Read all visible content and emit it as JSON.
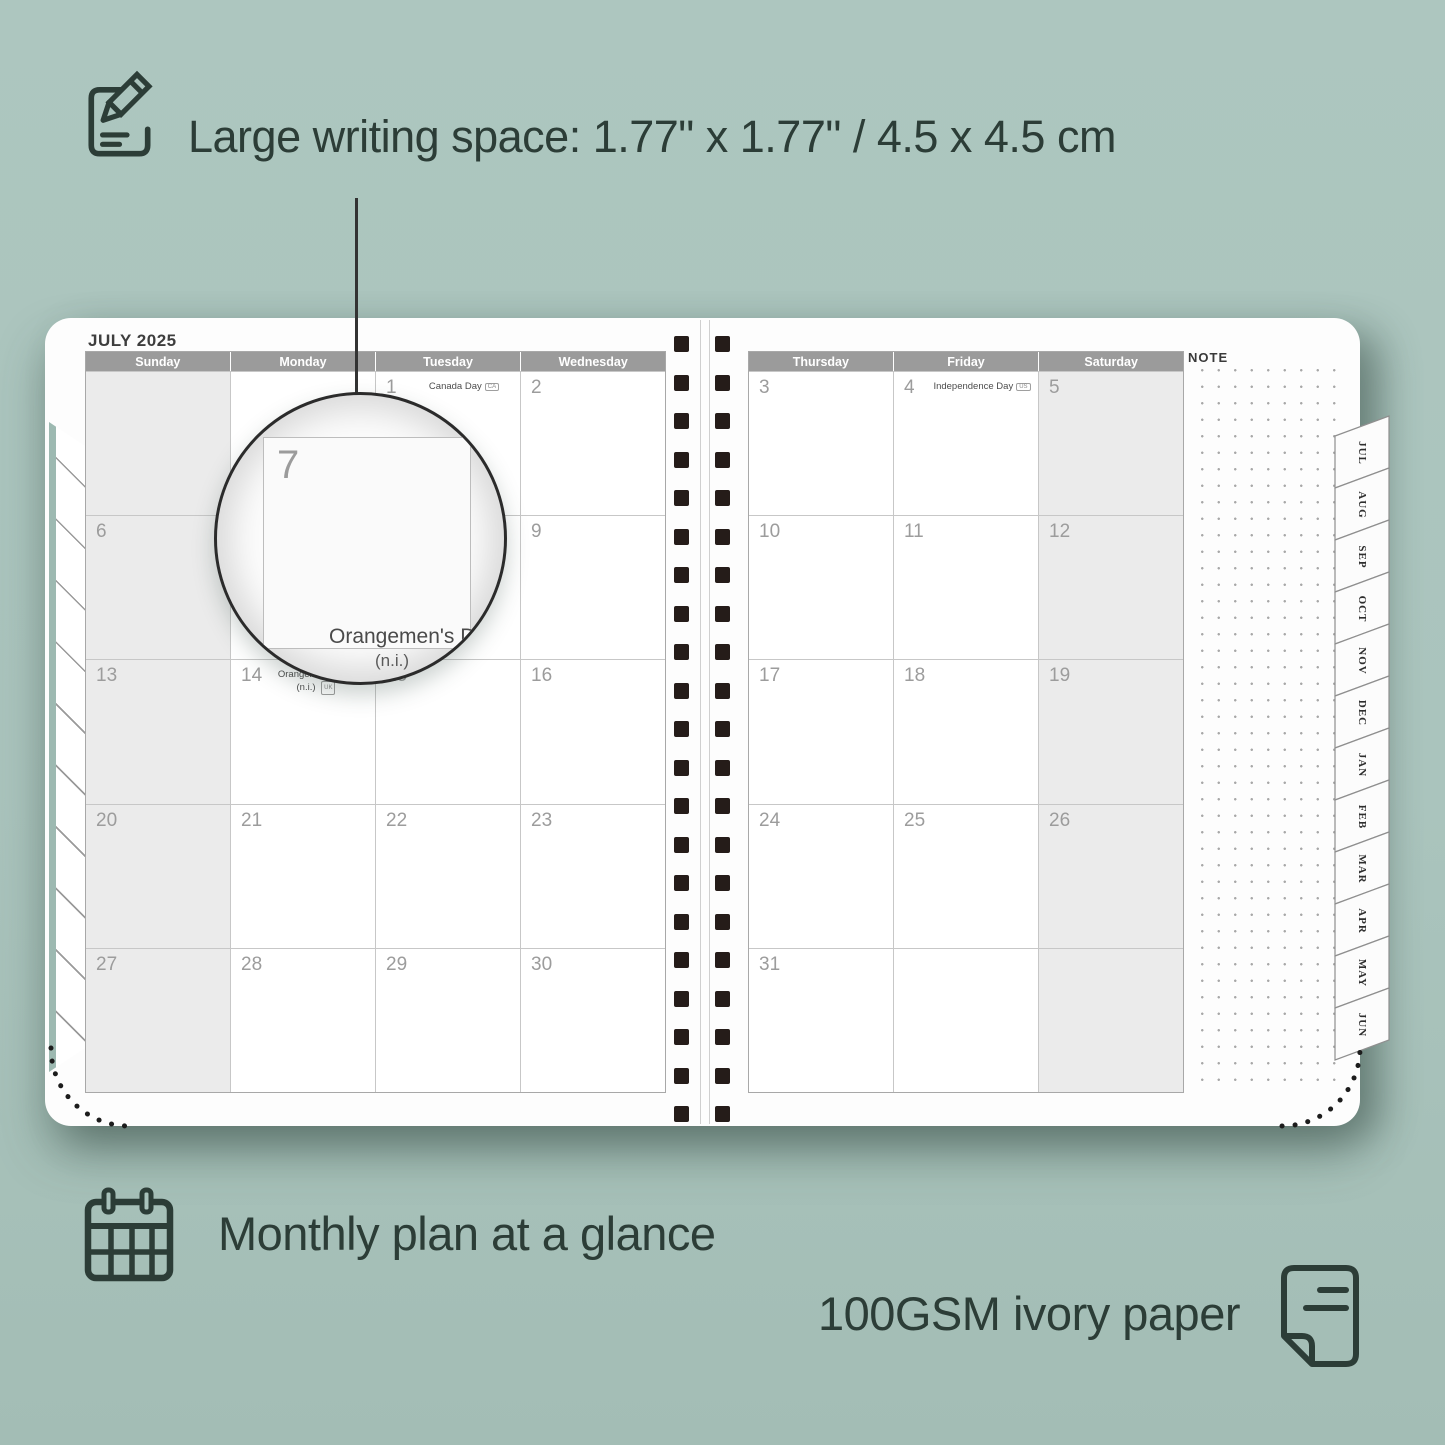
{
  "colors": {
    "background": "#aac4bd",
    "ink": "#2c3d37",
    "header_gray": "#9b9b9b",
    "weekend_shade": "#ebebeb",
    "binding_square": "#251c19",
    "page_white": "#fdfdfd"
  },
  "icons": {
    "top": "note-pencil-icon",
    "bottom_left": "calendar-grid-icon",
    "bottom_right": "paper-sheet-icon"
  },
  "hero": {
    "headline": "Large writing space: 1.77\" x 1.77\" / 4.5 x 4.5 cm"
  },
  "features": {
    "monthly": "Monthly plan at a glance",
    "paper": "100GSM ivory paper"
  },
  "planner": {
    "month_title": "JULY 2025",
    "note_label": "NOTE",
    "left_page": {
      "headers": [
        "Sunday",
        "Monday",
        "Tuesday",
        "Wednesday"
      ],
      "shade_col": 0,
      "weeks": [
        [
          null,
          null,
          {
            "d": "1",
            "h": "Canada Day",
            "b": "CA"
          },
          {
            "d": "2"
          }
        ],
        [
          {
            "d": "6"
          },
          {
            "d": "7"
          },
          {
            "d": "8"
          },
          {
            "d": "9"
          }
        ],
        [
          {
            "d": "13"
          },
          {
            "d": "14",
            "h": "Orangemen's Day",
            "h2": "(n.i.)",
            "b": "UK"
          },
          {
            "d": "15"
          },
          {
            "d": "16"
          }
        ],
        [
          {
            "d": "20"
          },
          {
            "d": "21"
          },
          {
            "d": "22"
          },
          {
            "d": "23"
          }
        ],
        [
          {
            "d": "27"
          },
          {
            "d": "28"
          },
          {
            "d": "29"
          },
          {
            "d": "30"
          }
        ]
      ]
    },
    "right_page": {
      "headers": [
        "Thursday",
        "Friday",
        "Saturday"
      ],
      "shade_col": 2,
      "weeks": [
        [
          {
            "d": "3"
          },
          {
            "d": "4",
            "h": "Independence Day",
            "b": "US"
          },
          {
            "d": "5"
          }
        ],
        [
          {
            "d": "10"
          },
          {
            "d": "11"
          },
          {
            "d": "12"
          }
        ],
        [
          {
            "d": "17"
          },
          {
            "d": "18"
          },
          {
            "d": "19"
          }
        ],
        [
          {
            "d": "24"
          },
          {
            "d": "25"
          },
          {
            "d": "26"
          }
        ],
        [
          {
            "d": "31"
          },
          null,
          null
        ]
      ]
    },
    "tabs": [
      "JUL",
      "AUG",
      "SEP",
      "OCT",
      "NOV",
      "DEC",
      "JAN",
      "FEB",
      "MAR",
      "APR",
      "MAY",
      "JUN"
    ]
  },
  "magnifier": {
    "day": "7",
    "holiday_line1": "Orangemen's Day",
    "holiday_line2": "(n.i.)"
  }
}
